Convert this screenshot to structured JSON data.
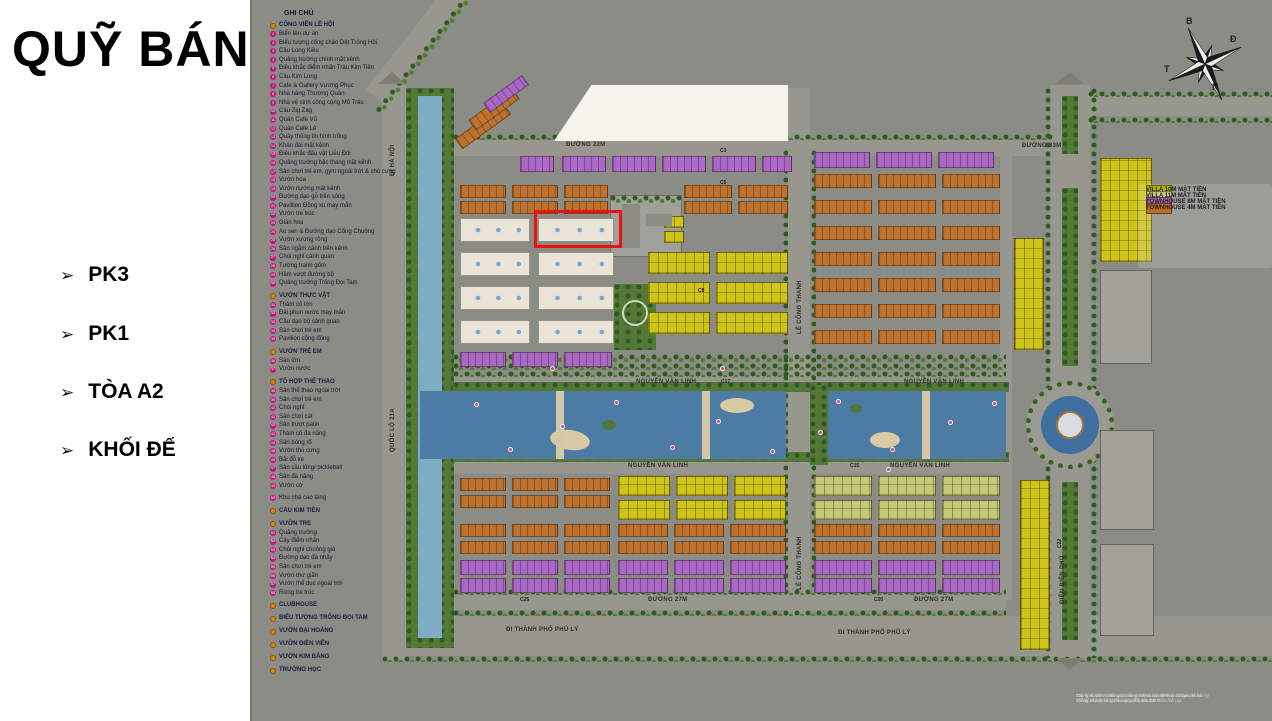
{
  "panel": {
    "title": "QUỸ BÁN",
    "bullet": "➢",
    "items": [
      {
        "label": "PK3"
      },
      {
        "label": "PK1"
      },
      {
        "label": "TÒA A2"
      },
      {
        "label": "KHỐI ĐẾ"
      }
    ]
  },
  "map_legend": {
    "title": "GHI CHÚ",
    "sections": [
      {
        "header": "CÔNG VIÊN LỄ HỘI",
        "items": [
          "Biển tên dự án",
          "Biểu tượng cổng chào Dệt Trống Hội",
          "Cầu Long Kiều",
          "Quảng trường chính mặt kênh",
          "Điêu khắc điểm nhấn Trâu Kim Tiền",
          "Cầu Kim Long",
          "Cafe & Gallery Vương Phục",
          "Nhà hàng Thương Quân",
          "Nhà vệ sinh công cộng Mõ Trâu",
          "Cầu Zig Zag",
          "Quán Cafe Vũ",
          "Quán Cafe Lê",
          "Quầy thông tin hình trống",
          "Khán đài mặt kênh",
          "Điêu khắc đấu vật Liễu Đôi",
          "Quảng trường bậc thang mặt kênh",
          "Sân chơi trẻ em, gym ngoài trời & chó cưng",
          "Vườn hoa",
          "Vườn nướng mặt kênh",
          "Đường dạo gỗ trên sông",
          "Pavillion Đồng xu may mắn",
          "Vườn tre trúc",
          "Giàn hoa",
          "Ao sen & Đường dạo Cổng Chuông",
          "Vườn xương rồng",
          "Sân ngắm cảnh trên kênh",
          "Chòi nghỉ cảnh quan",
          "Tường tranh gốm",
          "Hầm vượt đường bộ",
          "Quảng trường Trống Đọi Tam"
        ]
      },
      {
        "header": "VƯỜN THỰC VẬT",
        "items": [
          "Thảm cỏ lớn",
          "Đài phun nước may mắn",
          "Cầu dạo bộ cảnh quan",
          "Sân chơi trẻ em",
          "Pavilion cộng đồng"
        ]
      },
      {
        "header": "VƯỜN TRẺ EM",
        "items": [
          "Sân lớn",
          "Vườn nước"
        ]
      },
      {
        "header": "TỔ HỢP THỂ THAO",
        "items": [
          "Sân thể thao ngoài trời",
          "Sân chơi trẻ em",
          "Chòi nghỉ",
          "Sân chơi cát",
          "Sân trượt patin",
          "Thảm cỏ đa năng",
          "Sân bóng rổ",
          "Vườn thú cưng",
          "Bãi đỗ xe",
          "Sân cầu lông/ pickleball",
          "Sân đa năng",
          "Vườn cờ"
        ]
      },
      {
        "header": "",
        "items": [
          "Khu nhà cao tầng"
        ]
      },
      {
        "header": "CẦU KIM TIỀN",
        "items": []
      },
      {
        "header": "VƯỜN TRE",
        "items": [
          "Quảng trường",
          "Cây điểm nhấn",
          "Chòi nghỉ chuông gió",
          "Đường dạo đá nhảy",
          "Sân chơi trẻ em",
          "Vườn thư giãn",
          "Vườn thể dục ngoài trời",
          "Rừng tre trúc"
        ]
      },
      {
        "header": "CLUBHOUSE",
        "items": []
      },
      {
        "header": "BIỂU TƯỢNG TRỐNG ĐỌI TAM",
        "items": []
      },
      {
        "header": "VƯỜN ĐẠI HOÀNG",
        "items": []
      },
      {
        "header": "VƯỜN ĐIỀN VIÊN",
        "items": []
      },
      {
        "header": "VƯỜN KIM BẢNG",
        "items": []
      },
      {
        "header": "TRƯỜNG HỌC",
        "items": []
      }
    ]
  },
  "villa_legend": {
    "items": [
      {
        "label": "VILLA 10M MẶT TIỀN",
        "color": "#b8b40a"
      },
      {
        "label": "VILLA 11M MẶT TIỀN",
        "color": "#c8cb78"
      },
      {
        "label": "TOWNHOUSE 8M MẶT TIỀN",
        "color": "#a968c4"
      },
      {
        "label": "TOWNHOUSE 4M MẶT TIỀN",
        "color": "#bd6f2a"
      }
    ]
  },
  "compass": {
    "north": "B",
    "east": "Đ",
    "south": "N",
    "west": "T"
  },
  "disclaimer": {
    "line1": "Các hình ảnh và thông số mang tính chất minh họa và tham khảo. Thông số bản vẽ chỉ là tương đối đến thời điểm hiện tại.",
    "line2": "Thông số chính thức của mỗi căn được xác định cụ thể tại văn bản ký kết với Khách hàng theo quy định của CĐT."
  },
  "map": {
    "colors": {
      "P": "#a968c4",
      "O": "#bd7230",
      "Y": "#cfc41a",
      "G": "#c6c97a",
      "W": "#eae5d6",
      "S": "#a2a29b"
    },
    "road_labels": [
      {
        "t": "ĐI HÀ NỘI",
        "x": 140,
        "y": 176,
        "r": -90
      },
      {
        "t": "QUỐC LỘ 21A",
        "x": 140,
        "y": 452,
        "r": -90
      },
      {
        "t": "ĐƯỜNG 22M",
        "x": 316,
        "y": 142,
        "r": 0
      },
      {
        "t": "ĐƯỜNG 33M",
        "x": 772,
        "y": 143,
        "r": 0
      },
      {
        "t": "LÊ CÔNG THANH",
        "x": 547,
        "y": 334,
        "r": -90
      },
      {
        "t": "LÊ CÔNG THANH",
        "x": 547,
        "y": 590,
        "r": -90
      },
      {
        "t": "NGUYỄN VĂN LINH",
        "x": 386,
        "y": 379,
        "r": 0
      },
      {
        "t": "NGUYỄN VĂN LINH",
        "x": 378,
        "y": 463,
        "r": 0
      },
      {
        "t": "NGUYỄN VĂN LINH",
        "x": 654,
        "y": 379,
        "r": 0
      },
      {
        "t": "NGUYỄN VĂN LINH",
        "x": 640,
        "y": 463,
        "r": 0
      },
      {
        "t": "ĐƯỜNG 27M",
        "x": 398,
        "y": 597,
        "r": 0
      },
      {
        "t": "ĐƯỜNG 27M",
        "x": 664,
        "y": 597,
        "r": 0
      },
      {
        "t": "ĐI THÀNH PHỐ PHỦ LÝ",
        "x": 256,
        "y": 627,
        "r": 0
      },
      {
        "t": "ĐI THÀNH PHỐ PHỦ LÝ",
        "x": 588,
        "y": 630,
        "r": 0
      },
      {
        "t": "ĐIỆN BIÊN PHỦ",
        "x": 810,
        "y": 604,
        "r": -90
      }
    ],
    "block_codes": [
      {
        "t": "C3",
        "x": 470,
        "y": 148,
        "r": 0
      },
      {
        "t": "C5",
        "x": 470,
        "y": 180,
        "r": 0
      },
      {
        "t": "C8",
        "x": 448,
        "y": 288,
        "r": 0
      },
      {
        "t": "C17",
        "x": 471,
        "y": 379,
        "r": 0
      },
      {
        "t": "C15",
        "x": 600,
        "y": 463,
        "r": 0
      },
      {
        "t": "C20",
        "x": 624,
        "y": 597,
        "r": 0
      },
      {
        "t": "C25",
        "x": 270,
        "y": 597,
        "r": 0
      },
      {
        "t": "C22",
        "x": 807,
        "y": 548,
        "r": -90
      }
    ],
    "markers": [
      [
        224,
        402
      ],
      [
        258,
        447
      ],
      [
        310,
        424
      ],
      [
        364,
        400
      ],
      [
        420,
        445
      ],
      [
        466,
        419
      ],
      [
        520,
        449
      ],
      [
        586,
        399
      ],
      [
        640,
        447
      ],
      [
        698,
        420
      ],
      [
        742,
        401
      ],
      [
        300,
        366
      ],
      [
        470,
        366
      ],
      [
        636,
        467
      ],
      [
        568,
        430
      ]
    ],
    "blocks": [
      [
        203,
        120,
        60,
        13,
        "O",
        -36
      ],
      [
        217,
        103,
        54,
        13,
        "O",
        -36
      ],
      [
        232,
        88,
        48,
        12,
        "P",
        -36
      ],
      [
        270,
        156,
        34,
        16,
        "P"
      ],
      [
        312,
        156,
        44,
        16,
        "P"
      ],
      [
        362,
        156,
        44,
        16,
        "P"
      ],
      [
        412,
        156,
        44,
        16,
        "P"
      ],
      [
        462,
        156,
        44,
        16,
        "P"
      ],
      [
        512,
        156,
        30,
        16,
        "P"
      ],
      [
        210,
        185,
        46,
        13,
        "O"
      ],
      [
        262,
        185,
        46,
        13,
        "O"
      ],
      [
        314,
        185,
        44,
        13,
        "O"
      ],
      [
        434,
        185,
        48,
        13,
        "O"
      ],
      [
        488,
        185,
        50,
        13,
        "O"
      ],
      [
        210,
        201,
        46,
        13,
        "O"
      ],
      [
        262,
        201,
        46,
        13,
        "O"
      ],
      [
        314,
        201,
        44,
        13,
        "O"
      ],
      [
        434,
        201,
        48,
        13,
        "O"
      ],
      [
        488,
        201,
        50,
        13,
        "O"
      ],
      [
        210,
        218,
        70,
        24,
        "W"
      ],
      [
        288,
        218,
        76,
        24,
        "W"
      ],
      [
        210,
        252,
        70,
        24,
        "W"
      ],
      [
        288,
        252,
        76,
        24,
        "W"
      ],
      [
        210,
        286,
        70,
        24,
        "W"
      ],
      [
        288,
        286,
        76,
        24,
        "W"
      ],
      [
        210,
        320,
        70,
        24,
        "W"
      ],
      [
        288,
        320,
        76,
        24,
        "W"
      ],
      [
        210,
        352,
        46,
        15,
        "P"
      ],
      [
        262,
        352,
        46,
        15,
        "P"
      ],
      [
        314,
        352,
        48,
        15,
        "P"
      ],
      [
        398,
        252,
        62,
        22,
        "Y"
      ],
      [
        466,
        252,
        72,
        22,
        "Y"
      ],
      [
        398,
        282,
        62,
        22,
        "Y"
      ],
      [
        466,
        282,
        72,
        22,
        "Y"
      ],
      [
        398,
        312,
        62,
        22,
        "Y"
      ],
      [
        466,
        312,
        72,
        22,
        "Y"
      ],
      [
        414,
        216,
        20,
        12,
        "Y"
      ],
      [
        414,
        231,
        20,
        12,
        "Y"
      ],
      [
        564,
        152,
        56,
        16,
        "P"
      ],
      [
        626,
        152,
        56,
        16,
        "P"
      ],
      [
        688,
        152,
        56,
        16,
        "P"
      ],
      [
        564,
        174,
        58,
        14,
        "O"
      ],
      [
        628,
        174,
        58,
        14,
        "O"
      ],
      [
        692,
        174,
        58,
        14,
        "O"
      ],
      [
        564,
        200,
        58,
        14,
        "O"
      ],
      [
        628,
        200,
        58,
        14,
        "O"
      ],
      [
        692,
        200,
        58,
        14,
        "O"
      ],
      [
        564,
        226,
        58,
        14,
        "O"
      ],
      [
        628,
        226,
        58,
        14,
        "O"
      ],
      [
        692,
        226,
        58,
        14,
        "O"
      ],
      [
        564,
        252,
        58,
        14,
        "O"
      ],
      [
        628,
        252,
        58,
        14,
        "O"
      ],
      [
        692,
        252,
        58,
        14,
        "O"
      ],
      [
        564,
        278,
        58,
        14,
        "O"
      ],
      [
        628,
        278,
        58,
        14,
        "O"
      ],
      [
        692,
        278,
        58,
        14,
        "O"
      ],
      [
        564,
        304,
        58,
        14,
        "O"
      ],
      [
        628,
        304,
        58,
        14,
        "O"
      ],
      [
        692,
        304,
        58,
        14,
        "O"
      ],
      [
        564,
        330,
        58,
        14,
        "O"
      ],
      [
        628,
        330,
        58,
        14,
        "O"
      ],
      [
        692,
        330,
        58,
        14,
        "O"
      ],
      [
        764,
        238,
        30,
        112,
        "Y"
      ],
      [
        850,
        158,
        52,
        104,
        "Y"
      ],
      [
        850,
        270,
        52,
        94,
        "S"
      ],
      [
        210,
        478,
        46,
        13,
        "O"
      ],
      [
        262,
        478,
        46,
        13,
        "O"
      ],
      [
        314,
        478,
        46,
        13,
        "O"
      ],
      [
        210,
        495,
        46,
        13,
        "O"
      ],
      [
        262,
        495,
        46,
        13,
        "O"
      ],
      [
        314,
        495,
        46,
        13,
        "O"
      ],
      [
        368,
        476,
        52,
        20,
        "Y"
      ],
      [
        426,
        476,
        52,
        20,
        "Y"
      ],
      [
        484,
        476,
        52,
        20,
        "Y"
      ],
      [
        368,
        500,
        52,
        20,
        "Y"
      ],
      [
        426,
        500,
        52,
        20,
        "Y"
      ],
      [
        484,
        500,
        52,
        20,
        "Y"
      ],
      [
        210,
        524,
        46,
        13,
        "O"
      ],
      [
        262,
        524,
        46,
        13,
        "O"
      ],
      [
        314,
        524,
        46,
        13,
        "O"
      ],
      [
        368,
        524,
        50,
        13,
        "O"
      ],
      [
        424,
        524,
        50,
        13,
        "O"
      ],
      [
        480,
        524,
        56,
        13,
        "O"
      ],
      [
        210,
        541,
        46,
        13,
        "O"
      ],
      [
        262,
        541,
        46,
        13,
        "O"
      ],
      [
        314,
        541,
        46,
        13,
        "O"
      ],
      [
        368,
        541,
        50,
        13,
        "O"
      ],
      [
        424,
        541,
        50,
        13,
        "O"
      ],
      [
        480,
        541,
        56,
        13,
        "O"
      ],
      [
        210,
        560,
        46,
        15,
        "P"
      ],
      [
        262,
        560,
        46,
        15,
        "P"
      ],
      [
        314,
        560,
        46,
        15,
        "P"
      ],
      [
        368,
        560,
        50,
        15,
        "P"
      ],
      [
        424,
        560,
        50,
        15,
        "P"
      ],
      [
        480,
        560,
        56,
        15,
        "P"
      ],
      [
        210,
        578,
        46,
        15,
        "P"
      ],
      [
        262,
        578,
        46,
        15,
        "P"
      ],
      [
        314,
        578,
        46,
        15,
        "P"
      ],
      [
        368,
        578,
        50,
        15,
        "P"
      ],
      [
        424,
        578,
        50,
        15,
        "P"
      ],
      [
        480,
        578,
        56,
        15,
        "P"
      ],
      [
        564,
        476,
        58,
        20,
        "G"
      ],
      [
        628,
        476,
        58,
        20,
        "G"
      ],
      [
        692,
        476,
        58,
        20,
        "G"
      ],
      [
        564,
        500,
        58,
        20,
        "G"
      ],
      [
        628,
        500,
        58,
        20,
        "G"
      ],
      [
        692,
        500,
        58,
        20,
        "G"
      ],
      [
        564,
        524,
        58,
        13,
        "O"
      ],
      [
        628,
        524,
        58,
        13,
        "O"
      ],
      [
        692,
        524,
        58,
        13,
        "O"
      ],
      [
        564,
        541,
        58,
        13,
        "O"
      ],
      [
        628,
        541,
        58,
        13,
        "O"
      ],
      [
        692,
        541,
        58,
        13,
        "O"
      ],
      [
        564,
        560,
        58,
        15,
        "P"
      ],
      [
        628,
        560,
        58,
        15,
        "P"
      ],
      [
        692,
        560,
        58,
        15,
        "P"
      ],
      [
        564,
        578,
        58,
        15,
        "P"
      ],
      [
        628,
        578,
        58,
        15,
        "P"
      ],
      [
        692,
        578,
        58,
        15,
        "P"
      ],
      [
        770,
        480,
        30,
        170,
        "Y"
      ],
      [
        850,
        430,
        54,
        100,
        "S"
      ],
      [
        850,
        544,
        54,
        92,
        "S"
      ]
    ]
  }
}
